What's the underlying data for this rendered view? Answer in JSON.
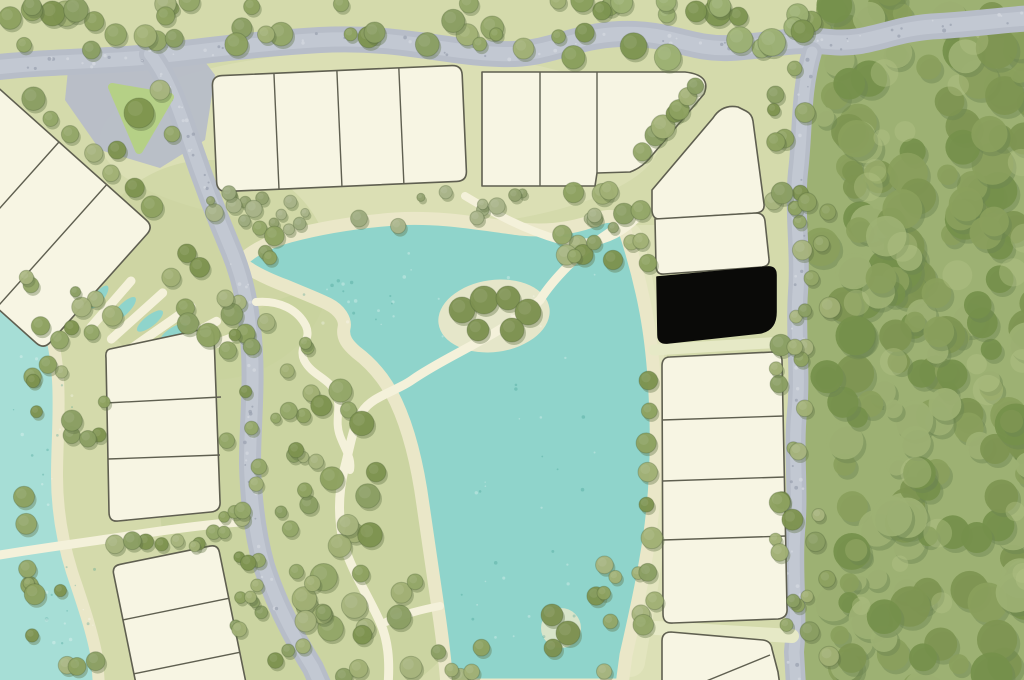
{
  "map": {
    "scene": "Watercolor residential master-plan: central lake with park paths, perimeter forest, gravel roads and subdivision lots; one lot highlighted black",
    "selected_lot": {
      "label": "selected lot",
      "fill": "#0a0a08",
      "location": "east lot column, between the corner parcels and the lower row, fronting the perimeter road"
    },
    "counts": {
      "visible_lots": 25,
      "highlighted_lots": 1,
      "lot_blocks": 10
    },
    "palette": {
      "lawn": "#d4daab",
      "lawn_light": "#e0e3bb",
      "park": "#c8d29d",
      "water": "#8fd4cb",
      "water_light": "#a6ded6",
      "sand": "#eae7c8",
      "shore": "#e3e5bf",
      "road": "#b7bdc8",
      "road_light": "#cacfd8",
      "path": "#f4f1da",
      "lot_fill": "#f7f5e3",
      "lot_stroke": "#5f5f50",
      "forest": "#9db173",
      "forest_dark": "#7e9551",
      "forest_deep": "#6d8551",
      "forest_light": "#b5c288",
      "tree": "#94a768",
      "tree_dark": "#5e7145",
      "shrub": "#9dab7e",
      "hedge": "#e6e9c6",
      "triangle_green": "#b5d086",
      "selected": "#0a0a08"
    },
    "features": [
      "central-lake",
      "west-lake",
      "island-with-trees",
      "park-paths",
      "garden-ponds",
      "north-road",
      "internal-road",
      "east-perimeter-road",
      "forest-edge",
      "residential-lots",
      "selected-lot"
    ],
    "lot_blocks": [
      {
        "id": "northwest-diagonal-row",
        "lots": 3
      },
      {
        "id": "north-row-west",
        "lots": 4
      },
      {
        "id": "north-row-east",
        "lots": 3
      },
      {
        "id": "northeast-corner-lot",
        "lots": 1
      },
      {
        "id": "east-column-upper",
        "lots": 1
      },
      {
        "id": "east-column-selected",
        "lots": 1,
        "selected": true
      },
      {
        "id": "east-column-lower",
        "lots": 4
      },
      {
        "id": "southeast-bottom-row",
        "lots": 2
      },
      {
        "id": "west-mid-cluster",
        "lots": 3
      },
      {
        "id": "southwest-cluster",
        "lots": 3
      }
    ]
  }
}
